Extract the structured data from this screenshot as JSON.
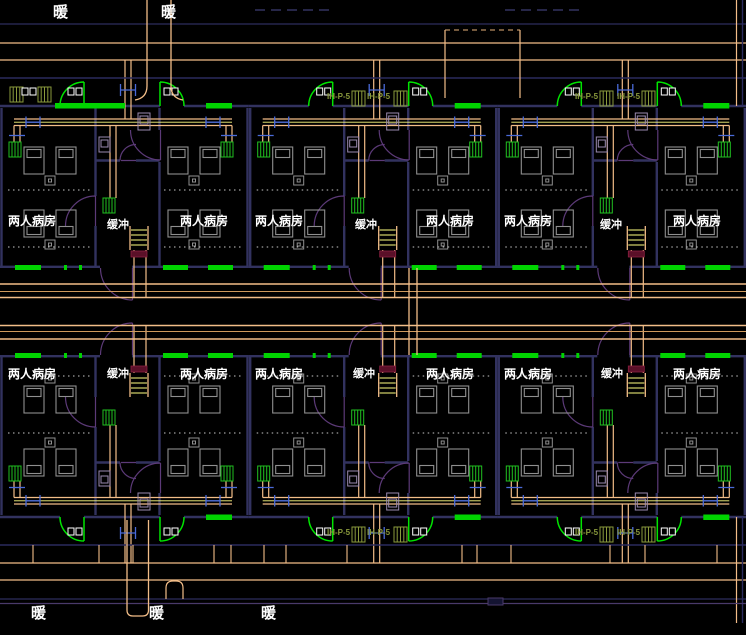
{
  "canvas": {
    "width": 746,
    "height": 635,
    "background": "#000000"
  },
  "drawing": {
    "kind": "hospital ward heating / HVAC floor plan (CAD)",
    "legend": {
      "ward_room": "两人病房",
      "buffer_room": "缓冲",
      "fan_coil_unit": "IH-P-5",
      "heating_riser": "暖"
    }
  },
  "colors": {
    "pipe_orange": "#f2bd88",
    "duct_yellow": "#ffff80",
    "door_green": "#00e400",
    "window_green": "#00d400",
    "wall_navy": "#32325f",
    "line_navy": "#2b2b5e",
    "arc_purple": "#5c3a78",
    "equipment_olive": "#8a9a3c",
    "furniture_gray": "#8f8f8f",
    "valve_blue": "#4a6ad8",
    "shaft_maroon": "#5a1028",
    "text_white": "#ffffff"
  },
  "labels": [
    {
      "type": "riser",
      "text": "暖",
      "x": 53,
      "y": 5
    },
    {
      "type": "riser",
      "text": "暖",
      "x": 161,
      "y": 5
    },
    {
      "type": "riser",
      "text": "暖",
      "x": 31,
      "y": 606
    },
    {
      "type": "riser",
      "text": "暖",
      "x": 149,
      "y": 606
    },
    {
      "type": "riser",
      "text": "暖",
      "x": 261,
      "y": 606
    },
    {
      "type": "ward",
      "text": "两人病房",
      "x": 8,
      "y": 215
    },
    {
      "type": "ward",
      "text": "两人病房",
      "x": 180,
      "y": 215
    },
    {
      "type": "ward",
      "text": "两人病房",
      "x": 255,
      "y": 215
    },
    {
      "type": "ward",
      "text": "两人病房",
      "x": 426,
      "y": 215
    },
    {
      "type": "ward",
      "text": "两人病房",
      "x": 504,
      "y": 215
    },
    {
      "type": "ward",
      "text": "两人病房",
      "x": 673,
      "y": 215
    },
    {
      "type": "buffer",
      "text": "缓冲",
      "x": 107,
      "y": 220
    },
    {
      "type": "buffer",
      "text": "缓冲",
      "x": 355,
      "y": 220
    },
    {
      "type": "buffer",
      "text": "缓冲",
      "x": 600,
      "y": 220
    },
    {
      "type": "ward",
      "text": "两人病房",
      "x": 8,
      "y": 368
    },
    {
      "type": "ward",
      "text": "两人病房",
      "x": 180,
      "y": 368
    },
    {
      "type": "ward",
      "text": "两人病房",
      "x": 255,
      "y": 368
    },
    {
      "type": "ward",
      "text": "两人病房",
      "x": 426,
      "y": 368
    },
    {
      "type": "ward",
      "text": "两人病房",
      "x": 504,
      "y": 368
    },
    {
      "type": "ward",
      "text": "两人病房",
      "x": 673,
      "y": 368
    },
    {
      "type": "buffer",
      "text": "缓冲",
      "x": 107,
      "y": 369
    },
    {
      "type": "buffer",
      "text": "缓冲",
      "x": 353,
      "y": 369
    },
    {
      "type": "buffer",
      "text": "缓冲",
      "x": 601,
      "y": 369
    },
    {
      "type": "equip",
      "text": "IH-P-5",
      "x": 327,
      "y": 93
    },
    {
      "type": "equip",
      "text": "IH-P-5",
      "x": 367,
      "y": 93
    },
    {
      "type": "equip",
      "text": "IH-P-5",
      "x": 575,
      "y": 93
    },
    {
      "type": "equip",
      "text": "IH-P-5",
      "x": 617,
      "y": 93
    },
    {
      "type": "equip",
      "text": "IH-P-5",
      "x": 327,
      "y": 529
    },
    {
      "type": "equip",
      "text": "IH-P-5",
      "x": 367,
      "y": 529
    },
    {
      "type": "equip",
      "text": "IH-P-5",
      "x": 575,
      "y": 529
    },
    {
      "type": "equip",
      "text": "IH-P-5",
      "x": 617,
      "y": 529
    }
  ]
}
